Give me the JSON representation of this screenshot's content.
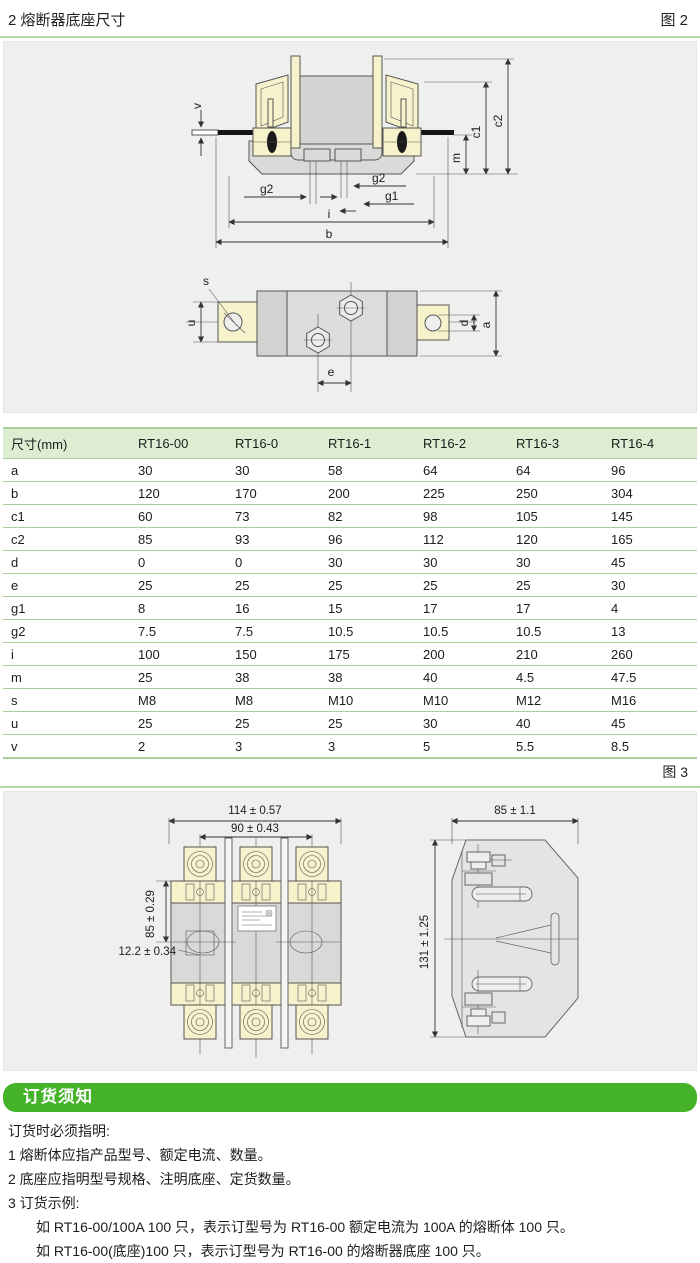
{
  "page": {
    "title": "2 熔断器底座尺寸"
  },
  "fig2": {
    "label": "图 2",
    "dims": {
      "v": "v",
      "g2_left": "g2",
      "g2_right": "g2",
      "g1": "g1",
      "i": "i",
      "b": "b",
      "m": "m",
      "c1": "c1",
      "c2": "c2",
      "s": "s",
      "u": "u",
      "e": "e",
      "d": "d",
      "a": "a"
    }
  },
  "fig3": {
    "label": "图 3",
    "dims": {
      "w114": "114 ± 0.57",
      "w90": "90 ± 0.43",
      "h85": "85 ± 0.29",
      "w122": "12.2 ± 0.34",
      "w85": "85 ± 1.1",
      "h131": "131 ± 1.25"
    }
  },
  "table": {
    "headers": [
      "尺寸(mm)",
      "RT16-00",
      "RT16-0",
      "RT16-1",
      "RT16-2",
      "RT16-3",
      "RT16-4"
    ],
    "rows": [
      [
        "a",
        "30",
        "30",
        "58",
        "64",
        "64",
        "96"
      ],
      [
        "b",
        "120",
        "170",
        "200",
        "225",
        "250",
        "304"
      ],
      [
        "c1",
        "60",
        "73",
        "82",
        "98",
        "105",
        "145"
      ],
      [
        "c2",
        "85",
        "93",
        "96",
        "112",
        "120",
        "165"
      ],
      [
        "d",
        "0",
        "0",
        "30",
        "30",
        "30",
        "45"
      ],
      [
        "e",
        "25",
        "25",
        "25",
        "25",
        "25",
        "30"
      ],
      [
        "g1",
        "8",
        "16",
        "15",
        "17",
        "17",
        "4"
      ],
      [
        "g2",
        "7.5",
        "7.5",
        "10.5",
        "10.5",
        "10.5",
        "13"
      ],
      [
        "i",
        "100",
        "150",
        "175",
        "200",
        "210",
        "260"
      ],
      [
        "m",
        "25",
        "38",
        "38",
        "40",
        "4.5",
        "47.5"
      ],
      [
        "s",
        "M8",
        "M8",
        "M10",
        "M10",
        "M12",
        "M16"
      ],
      [
        "u",
        "25",
        "25",
        "25",
        "30",
        "40",
        "45"
      ],
      [
        "v",
        "2",
        "3",
        "3",
        "5",
        "5.5",
        "8.5"
      ]
    ]
  },
  "ordering": {
    "header": "订货须知",
    "lines": [
      "订货时必须指明:",
      "1 熔断体应指产品型号、额定电流、数量。",
      "2 底座应指明型号规格、注明底座、定货数量。",
      "3 订货示例:"
    ],
    "examples": [
      "如 RT16-00/100A  100 只，表示订型号为 RT16-00 额定电流为 100A 的熔断体 100 只。",
      "如 RT16-00(底座)100 只，表示订型号为 RT16-00 的熔断器底座 100 只。"
    ]
  },
  "colors": {
    "accent_green": "#45b32a",
    "table_line_green": "#a9cf98",
    "header_bg_green": "#dcedd2",
    "rule_green": "#b3d7a4",
    "panel_bg": "#efefee",
    "drawing_yellow": "#f6f2cc",
    "drawing_gray": "#d9d9d7"
  }
}
